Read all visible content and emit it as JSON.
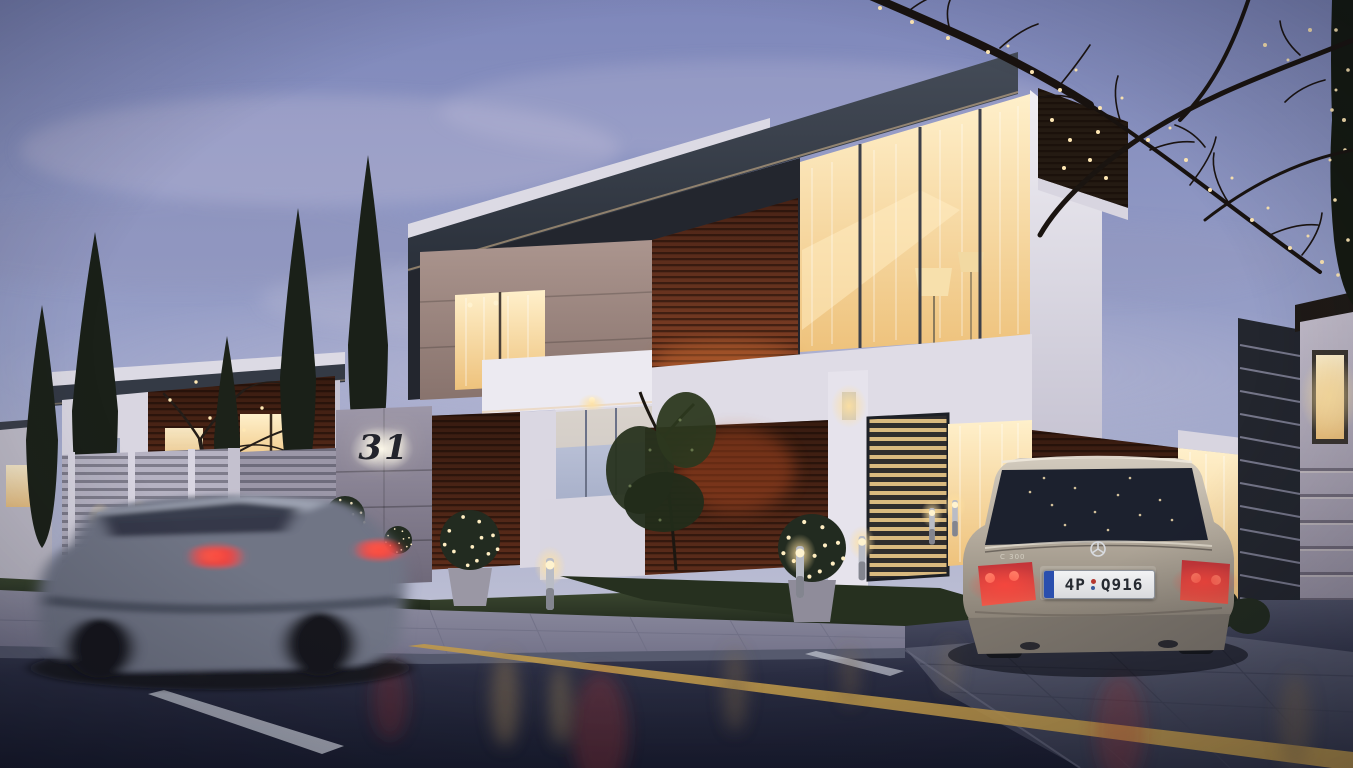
{
  "meta": {
    "domain": "architectural-rendering",
    "scene_title": "Modern two-storey villa no. 31 at dusk",
    "time_of_day": "dusk",
    "conditions": "wet street with light reflections"
  },
  "signage": {
    "house_number": "31"
  },
  "vehicles": {
    "parked_car": {
      "type": "sedan",
      "brand_emblem": "mercedes-star",
      "model_badge": "C 300",
      "color_name": "silver-beige",
      "taillights": "lit red",
      "license_plate": {
        "prefix": "4P",
        "suffix": "Q916",
        "full": "4P Q916",
        "style": "EU white plate with blue band and red seal"
      }
    },
    "moving_car": {
      "type": "sedan",
      "color_name": "grey",
      "motion": "motion-blurred, driving past",
      "taillights": "lit red"
    }
  },
  "architecture": {
    "main_house": [
      "white rendered volumes",
      "exposed concrete box with lit window",
      "dark red-brown timber slat cladding",
      "dark flat roof fascia",
      "full-height glazing with warm interior light and sheer curtains",
      "drum-shade floor lamps visible inside",
      "louvered metal privacy screens",
      "concrete entrance pier with backlit house number",
      "entrance canopy with downlight"
    ],
    "left_house": [
      "similar modern villa",
      "timber slat band",
      "warm lit windows",
      "white louver fence"
    ],
    "right_boundary": [
      "render pier with recessed warm wall light",
      "dark horizontal-louver gate"
    ]
  },
  "landscape": [
    "tall cypress trees",
    "bare deciduous trees strung with fairy lights",
    "topiary balls with fairy lights in pots",
    "lawn strips",
    "bollard path lights"
  ],
  "road": {
    "markings": [
      "yellow edge line",
      "white dashed lane line"
    ],
    "surface": "wet dark asphalt",
    "sidewalk": "grey paver band with stone curb",
    "driveway": "dark paver apron"
  },
  "palette": {
    "sky_top": "#7e87ba",
    "sky_horizon": "#ccc8d8",
    "warm_light": "#ffe9b8",
    "timber": "#6b3520",
    "roof_fascia": "#2c323c",
    "road": "#1a1d2f",
    "car_silver": "#b3aa9c",
    "taillight_red": "#e8504a",
    "cypress_green": "#1a2018"
  }
}
